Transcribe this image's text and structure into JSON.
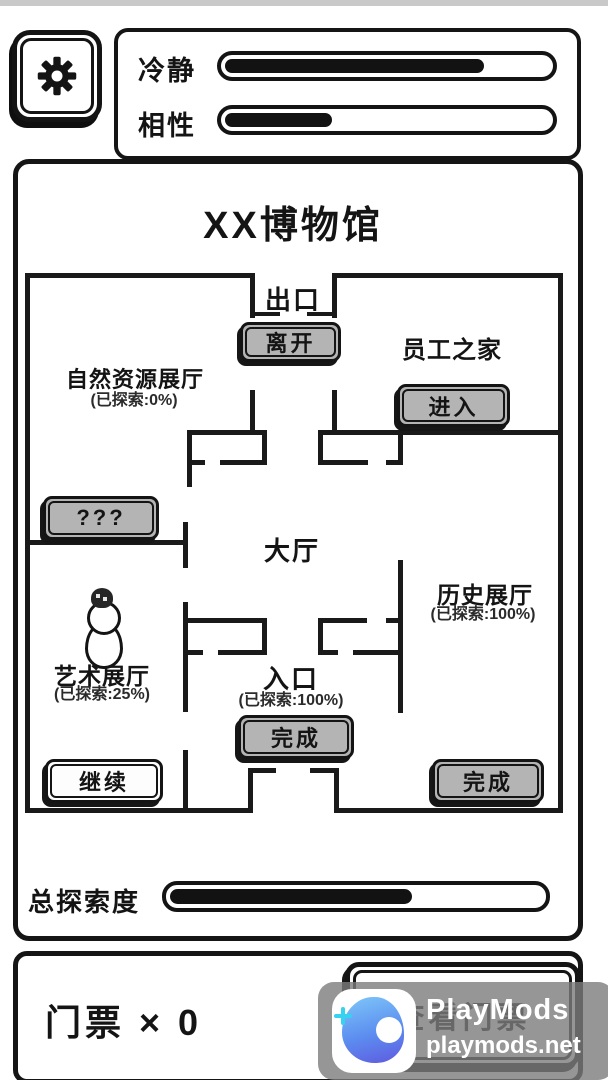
{
  "status": {
    "bars": [
      {
        "label": "冷静",
        "percent": 80
      },
      {
        "label": "相性",
        "percent": 33
      }
    ]
  },
  "museum": {
    "title": "XX博物馆",
    "rooms": {
      "exit": {
        "label": "出口"
      },
      "staff_home": {
        "label": "员工之家"
      },
      "natural": {
        "label": "自然资源展厅",
        "explored": "(已探索:0%)"
      },
      "hall": {
        "label": "大厅"
      },
      "history": {
        "label": "历史展厅",
        "explored": "(已探索:100%)"
      },
      "art": {
        "label": "艺术展厅",
        "explored": "(已探索:25%)"
      },
      "entrance": {
        "label": "入口",
        "explored": "(已探索:100%)"
      }
    },
    "buttons": {
      "leave": "离开",
      "enter": "进入",
      "unknown": "???",
      "finish_entrance": "完成",
      "continue": "继续",
      "finish_history": "完成"
    },
    "exploration": {
      "label": "总探索度",
      "percent": 65
    }
  },
  "ticket_bar": {
    "count_text": "门票 × 0",
    "view_button": "查看门票"
  },
  "watermark": {
    "brand": "PlayMods",
    "domain": "playmods.net"
  },
  "colors": {
    "ink": "#151515",
    "button_gray": "#b4b4b4",
    "watermark_bg": "#7c7c7c",
    "brand_blue": "#5c8df0",
    "brand_cyan": "#35d3f0"
  }
}
